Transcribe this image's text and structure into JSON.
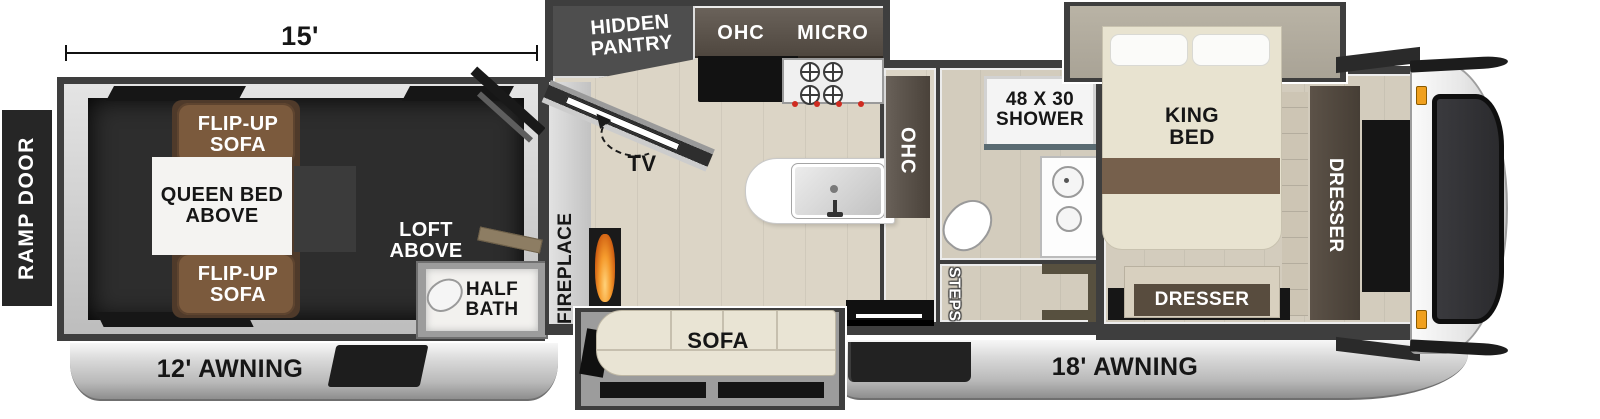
{
  "floorplan": {
    "dimension": "15'",
    "ramp_door": "RAMP DOOR",
    "awning_left": "12' AWNING",
    "awning_right": "18' AWNING",
    "garage": {
      "flip_up_sofa_top": "FLIP-UP SOFA",
      "queen_bed_above": "QUEEN BED ABOVE",
      "flip_up_sofa_bottom": "FLIP-UP SOFA",
      "loft_above": "LOFT ABOVE",
      "half_bath": "HALF BATH"
    },
    "kitchen": {
      "hidden_pantry": "HIDDEN PANTRY",
      "ohc": "OHC",
      "micro": "MICRO",
      "tv": "TV",
      "fireplace": "FIREPLACE",
      "sofa": "SOFA"
    },
    "hallway": {
      "ohc": "OHC",
      "pantry": "PANTRY",
      "steps": "STEPS"
    },
    "bathroom": {
      "shower": "48 X 30 SHOWER"
    },
    "bedroom": {
      "king_bed": "KING BED",
      "dresser_wardrobe": "DRESSER",
      "dresser_foot": "DRESSER"
    },
    "colors": {
      "wall": "#3e3e3e",
      "garage_floor": "#2d2d2d",
      "wood_floor": "#dcd5c6",
      "sofa_brown": "#7b5a3d",
      "cream_sofa": "#e9e4d4",
      "flame": "#e8862a",
      "skirt_silver": "#c9c9c9",
      "marker_light": "#f0a01e"
    }
  }
}
